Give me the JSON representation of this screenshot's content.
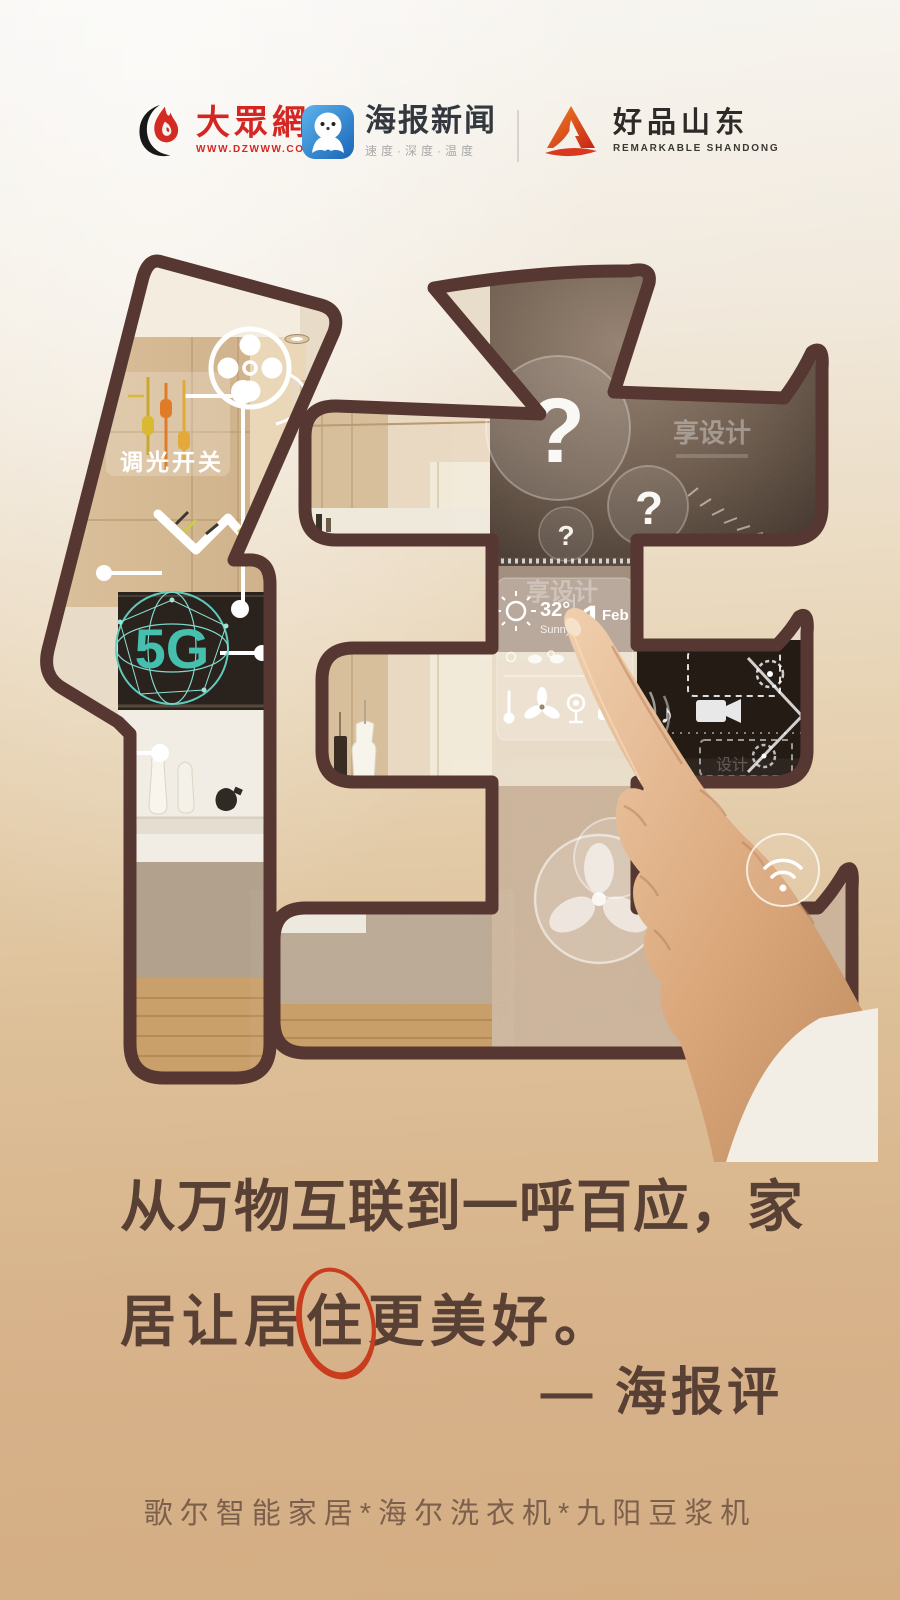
{
  "header": {
    "dzw": {
      "name": "大眾網",
      "url": "WWW.DZWWW.COM"
    },
    "haibao": {
      "title": "海报新闻",
      "tagline": "速度·深度·温度"
    },
    "haopin": {
      "title": "好品山东",
      "subtitle": "REMARKABLE SHANDONG"
    }
  },
  "artwork": {
    "glyph": "住",
    "labels": {
      "dimmer": "调光开关",
      "five_g": "5G",
      "q_large": "?",
      "q_medium": "?",
      "q_small": "?",
      "watermark1": "享设计",
      "watermark2": "享设计",
      "watermark3": "设计",
      "temp": "32°",
      "condition": "Sunny",
      "date_day": "1",
      "date_month": "Feb",
      "music_note": "♪"
    }
  },
  "quote": {
    "line1": "从万物互联到一呼百应，家",
    "line2_pre": "居让居",
    "line2_highlight": "住",
    "line2_post": "更美好。",
    "attribution": "— 海报评"
  },
  "footer": {
    "caption": "歌尔智能家居*海尔洗衣机*九阳豆浆机"
  },
  "colors": {
    "stroke_outline": "#573731",
    "page_top": "#f6f3ee",
    "page_bottom": "#d4ad83",
    "quote_text": "#594034",
    "highlight_ring": "#c93c1d",
    "brand_red": "#d42723",
    "brand_blue": "#2f8ed8",
    "brand_orange": "#e05a20",
    "teal_5g": "#45bfae",
    "caption_text": "#7d604c"
  }
}
